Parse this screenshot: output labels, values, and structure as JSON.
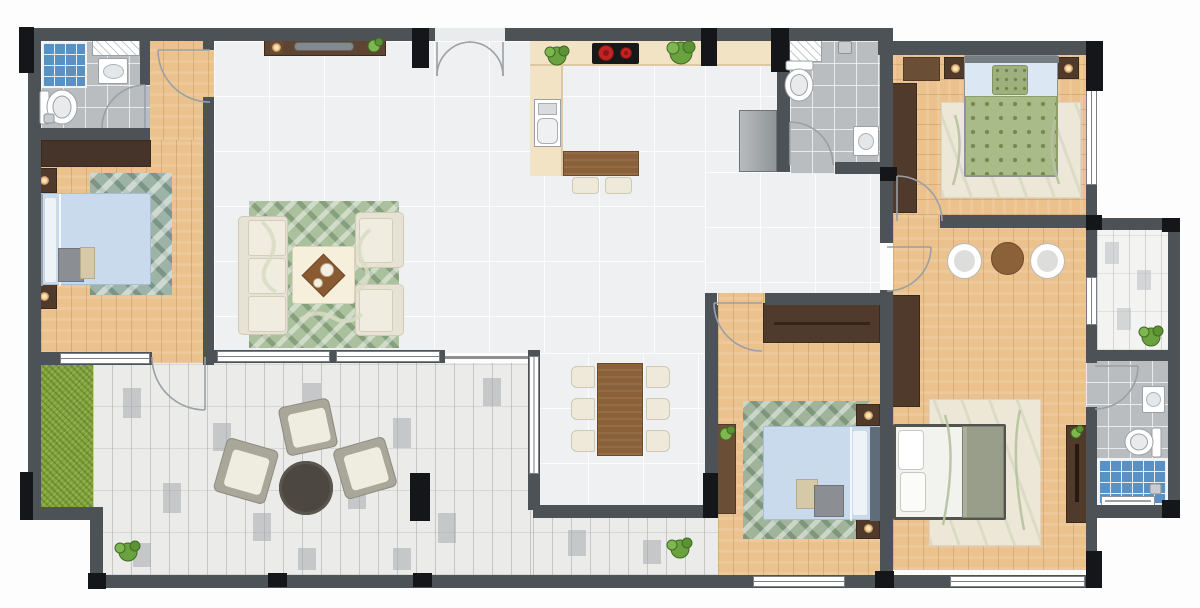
{
  "meta": {
    "title": "apartment-floor-plan",
    "view": "top-down 2D rendered floor plan",
    "canvas": {
      "width": 1200,
      "height": 608
    }
  },
  "palette": {
    "exterior": "#fdfdfd",
    "wall": "#4d5257",
    "column": "#141619",
    "tile_floor": "#eef0f1",
    "wood_floor": "#ebc28e",
    "paver_floor": "#ebebe9",
    "bath_tile": "#b9bdc0",
    "shower_tile": "#6ea7d8",
    "grass": "#83a33f",
    "counter": "#f3e3c5",
    "dark_wood": "#4f3a2b",
    "mid_wood": "#8a6138",
    "cream_fabric": "#efe9da",
    "bed_blue": "#c9daec",
    "bed_green_dotted": "#a9bb88",
    "bed_olive": "#989e8a",
    "rug_green": "#abc09c",
    "rug_teal": "#9db3a6",
    "rug_cream": "#ece7d7",
    "outdoor_chair": "#a8a79a",
    "outdoor_table": "#4c4740",
    "burner_red": "#c22424"
  },
  "rooms": [
    {
      "label": "Living Room",
      "floor": "ceramic tile",
      "items": [
        "tv console",
        "tv",
        "table lamp",
        "vase plant",
        "3-seat sofa",
        "armchair",
        "armchair",
        "coffee table with tray",
        "green swirl rug"
      ]
    },
    {
      "label": "Kitchen",
      "floor": "ceramic tile",
      "items": [
        "L-shaped counter",
        "double sink",
        "2-burner cooktop",
        "plant",
        "plant",
        "fridge",
        "island bar",
        "bar stool",
        "bar stool"
      ]
    },
    {
      "label": "Dining Area",
      "floor": "ceramic tile",
      "items": [
        "wood dining table",
        "6 chairs"
      ]
    },
    {
      "label": "Hallway",
      "floor": "ceramic tile",
      "items": []
    },
    {
      "label": "Bathroom 1",
      "floor": "grey tile",
      "items": [
        "blue tiled shower",
        "wall shelf",
        "sink",
        "toilet"
      ]
    },
    {
      "label": "Bedroom 1",
      "floor": "wood",
      "items": [
        "wardrobe",
        "double bed (blue)",
        "2 nightstands with lamps",
        "teal patterned rug",
        "foot cushions"
      ]
    },
    {
      "label": "Bathroom 2",
      "floor": "grey tile",
      "items": [
        "wall shelf",
        "toilet",
        "sink",
        "shower head"
      ]
    },
    {
      "label": "Bedroom 2",
      "floor": "wood",
      "items": [
        "wardrobe",
        "shelf",
        "double bed (green dotted)",
        "2 nightstands with lamps",
        "cream rug"
      ]
    },
    {
      "label": "Master Suite",
      "floor": "wood",
      "items": [
        "2 oval chairs",
        "round side table",
        "2 wardrobes",
        "double bed (olive/white)",
        "cream rug",
        "plant"
      ]
    },
    {
      "label": "Bathroom 3",
      "floor": "grey tile",
      "items": [
        "sink",
        "toilet",
        "blue tiled shower",
        "towel rail"
      ]
    },
    {
      "label": "Balcony",
      "floor": "light pavers",
      "items": [
        "plant"
      ]
    },
    {
      "label": "Terrace",
      "floor": "grey pavers",
      "items": [
        "grass bed",
        "3 outdoor armchairs",
        "round coffee table",
        "2 plants"
      ]
    }
  ],
  "openings": {
    "entrance": "double swing door, top wall",
    "interior_swing_doors": 8,
    "sliding_balcony_door": 1,
    "windows": 7,
    "terrace_opening": "open threshold from great room"
  }
}
